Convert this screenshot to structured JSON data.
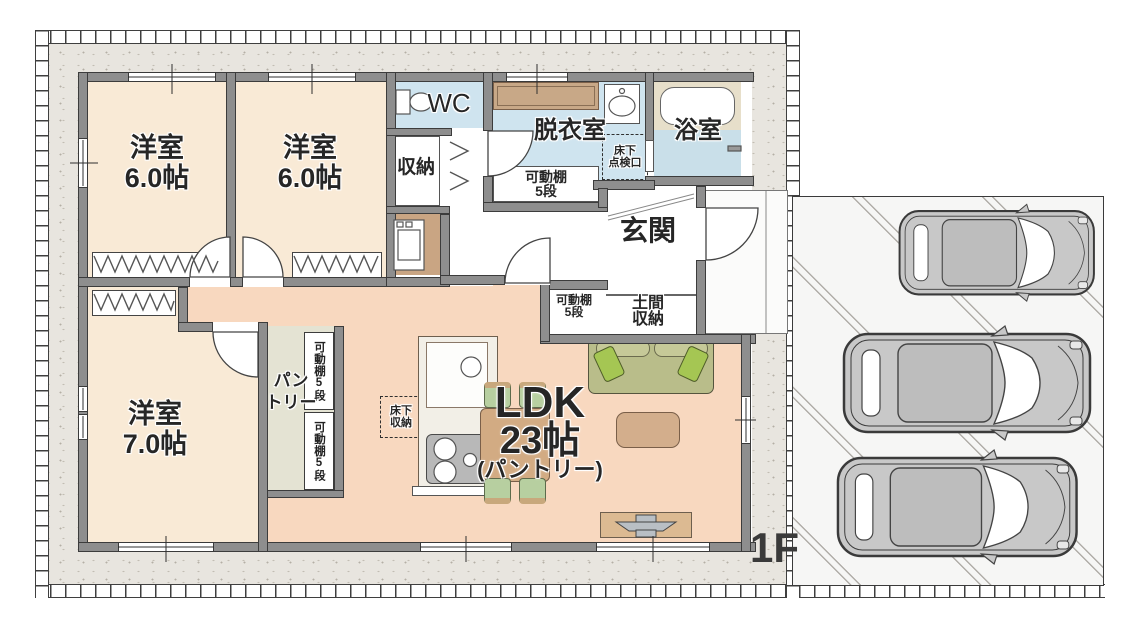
{
  "floor": {
    "label": "1F"
  },
  "rooms": {
    "bedroom1": {
      "name": "洋室",
      "size": "6.0帖"
    },
    "bedroom2": {
      "name": "洋室",
      "size": "6.0帖"
    },
    "bedroom3": {
      "name": "洋室",
      "size": "7.0帖"
    },
    "wc": {
      "name": "WC"
    },
    "hall_storage": {
      "name": "収納"
    },
    "dressing_room": {
      "name": "脱衣室"
    },
    "bathroom": {
      "name": "浴室"
    },
    "entrance": {
      "name": "玄関"
    },
    "entrance_storage": {
      "line1": "土間",
      "line2": "収納"
    },
    "pantry": {
      "line1": "パン",
      "line2": "トリー"
    },
    "ldk": {
      "name": "LDK",
      "size": "23帖",
      "note": "(パントリー)"
    }
  },
  "labels": {
    "movable_shelf_line1": "可動棚",
    "movable_shelf_line2": "5段",
    "movable_shelf_vertical": "可動棚5段",
    "underfloor_access_line1": "床下",
    "underfloor_access_line2": "点検口",
    "underfloor_storage_line1": "床下",
    "underfloor_storage_line2": "収納"
  },
  "colors": {
    "wall": "#8e8e8e",
    "bedroom_floor": "#f9ead6",
    "ldk_floor": "#f8d8bf",
    "pantry_floor": "#e4e3d3",
    "wet_area_floor": "#cfe4ef",
    "bath_floor": "#c9dfe9",
    "counter_wood": "#c8a887",
    "furniture_wood": "#d2ab83",
    "sofa_green": "#b9bd8a",
    "pillow_green": "#a5c653",
    "yard": "#e8e5df",
    "parking": "#f6f6f5",
    "car_gray": "#c8c8c8"
  }
}
